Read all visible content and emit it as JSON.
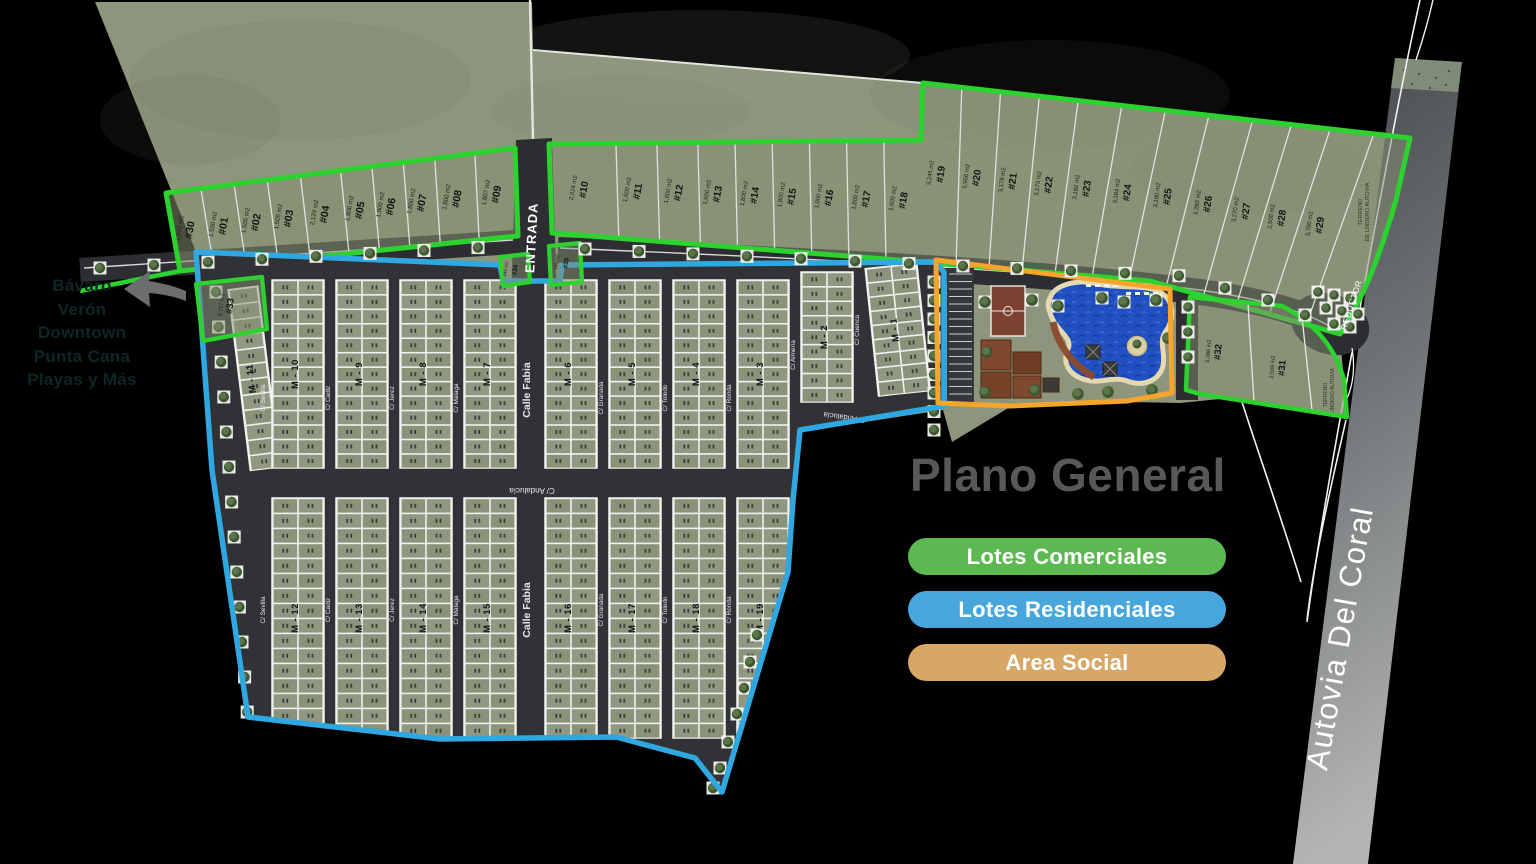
{
  "note": {
    "lines": [
      "Bávaro",
      "Verón",
      "Downtown",
      "Punta Cana",
      "Playas y Más"
    ]
  },
  "legend": {
    "title": "Plano General",
    "items": [
      {
        "label": "Lotes Comerciales",
        "color": "#5cb952",
        "outline": "#2cd32f"
      },
      {
        "label": "Lotes Residenciales",
        "color": "#47a7dc",
        "outline": "#2fa7e0"
      },
      {
        "label": "Area Social",
        "color": "#d7a766",
        "outline": "#f5a42c"
      }
    ]
  },
  "roads": {
    "entrance": "ENTRADA",
    "highway": "Autovia Del Coral",
    "reductor": "REDUCTOR",
    "cross_street": "C/ Andalucía",
    "lindero_note_1": "TERRENO",
    "lindero_note_2": "DE LINDERO AUTOVIA",
    "streets_top": [
      "C/ Sevilla",
      "C/ Cadiz",
      "C/ Jerez",
      "C/ Málaga",
      "Calle Fabia",
      "C/ Granada",
      "C/ Toledo",
      "C/ Ronda",
      "C/ Almería",
      "C/ Cuenca"
    ],
    "streets_bottom": [
      "C/ Sevilla",
      "C/ Cadiz",
      "C/ Jerez",
      "C/ Málaga",
      "Calle Fabia",
      "C/ Granada",
      "C/ Toledo",
      "C/ Ronda"
    ]
  },
  "commercial_lots_left": [
    {
      "num": "#30",
      "area": "1,922 m2"
    },
    {
      "num": "#01",
      "area": "1,500 m2"
    },
    {
      "num": "#02",
      "area": "1,505 m2"
    },
    {
      "num": "#03",
      "area": "1,505 m2"
    },
    {
      "num": "#04",
      "area": "2,124 m2"
    },
    {
      "num": "#05",
      "area": "1,800 m2"
    },
    {
      "num": "#06",
      "area": "1,800 m2"
    },
    {
      "num": "#07",
      "area": "1,800 m2"
    },
    {
      "num": "#08",
      "area": "1,800 m2"
    },
    {
      "num": "#09",
      "area": "1,807 m2"
    }
  ],
  "commercial_lots_right_a": [
    {
      "num": "#10",
      "area": "2,024 m2"
    },
    {
      "num": "#11",
      "area": "1,600 m2"
    },
    {
      "num": "#12",
      "area": "1,600 m2"
    },
    {
      "num": "#13",
      "area": "1,600 m2"
    },
    {
      "num": "#14",
      "area": "1,800 m2"
    },
    {
      "num": "#15",
      "area": "1,800 m2"
    },
    {
      "num": "#16",
      "area": "1,800 m2"
    },
    {
      "num": "#17",
      "area": "1,800 m2"
    },
    {
      "num": "#18",
      "area": "1,600 m2"
    }
  ],
  "commercial_lots_right_b": [
    {
      "num": "#19",
      "area": "3,245 m2"
    },
    {
      "num": "#20",
      "area": "3,956 m2"
    },
    {
      "num": "#21",
      "area": "3,178 m2"
    },
    {
      "num": "#22",
      "area": "3,173 m2"
    },
    {
      "num": "#23",
      "area": "3,182 m2"
    },
    {
      "num": "#24",
      "area": "3,184 m2"
    },
    {
      "num": "#25",
      "area": "3,180 m2"
    },
    {
      "num": "#26",
      "area": "3,280 m2"
    },
    {
      "num": "#27",
      "area": "3,270 m2"
    },
    {
      "num": "#28",
      "area": "2,500 m2"
    },
    {
      "num": "#29",
      "area": "3,790 m2"
    }
  ],
  "corner_lots": [
    {
      "num": "#32",
      "area": "5,086 m2"
    },
    {
      "num": "#31",
      "area": "2,509 m2"
    }
  ],
  "entry_lots": [
    {
      "num": "#33",
      "area": "1,717 m2"
    },
    {
      "num": "#34",
      "area": "440 m2"
    },
    {
      "num": "#35",
      "area": "546 m2"
    }
  ],
  "blocks_top": [
    "M - 11",
    "M - 10",
    "M - 9",
    "M - 8",
    "M - 7",
    "M - 6",
    "M - 5",
    "M - 4",
    "M - 3",
    "M - 2",
    "M - 1"
  ],
  "blocks_bottom": [
    "M - 12",
    "M - 13",
    "M - 14",
    "M - 15",
    "M - 16",
    "M - 17",
    "M - 18",
    "M - 19"
  ]
}
